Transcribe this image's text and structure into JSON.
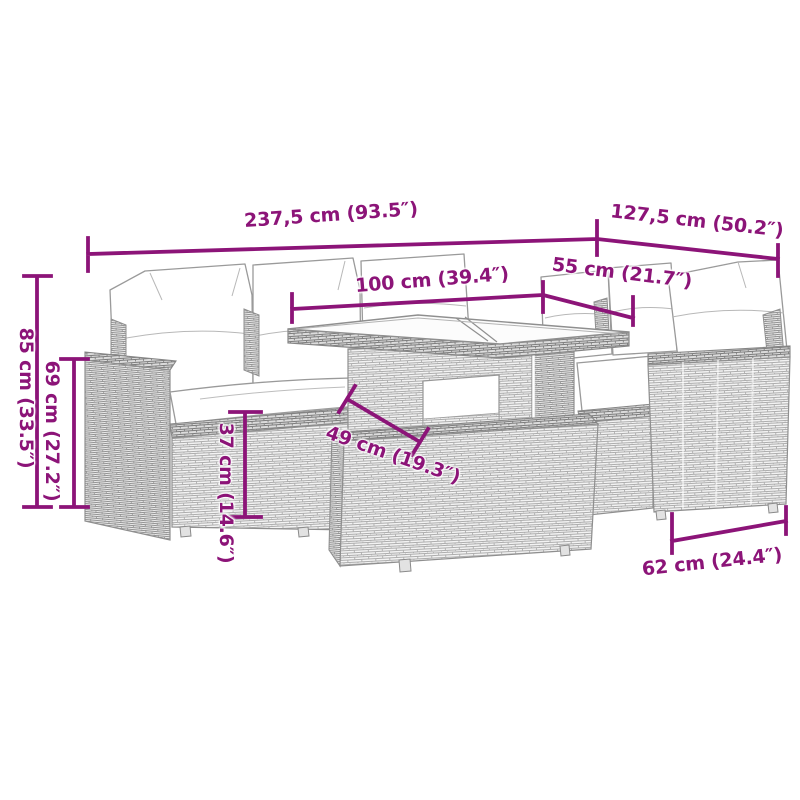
{
  "diagram": {
    "type": "product dimension diagram",
    "subject": "rattan garden lounge set with glass-top table and footstool"
  },
  "colors": {
    "dimension_accent": "#8c1478",
    "line_art": "#8f8f8f",
    "background": "#ffffff"
  },
  "dimensions": [
    {
      "id": "overall-width",
      "label": "237,5 cm (93.5″)"
    },
    {
      "id": "overall-depth",
      "label": "127,5 cm (50.2″)"
    },
    {
      "id": "table-length",
      "label": "100 cm (39.4″)"
    },
    {
      "id": "table-depth",
      "label": "55 cm (21.7″)"
    },
    {
      "id": "back-height",
      "label": "85 cm (33.5″)"
    },
    {
      "id": "arm-height",
      "label": "69 cm (27.2″)"
    },
    {
      "id": "seat-height",
      "label": "37 cm (14.6″)"
    },
    {
      "id": "seat-depth",
      "label": "49 cm (19.3″)"
    },
    {
      "id": "chair-width",
      "label": "62 cm (24.4″)"
    }
  ]
}
